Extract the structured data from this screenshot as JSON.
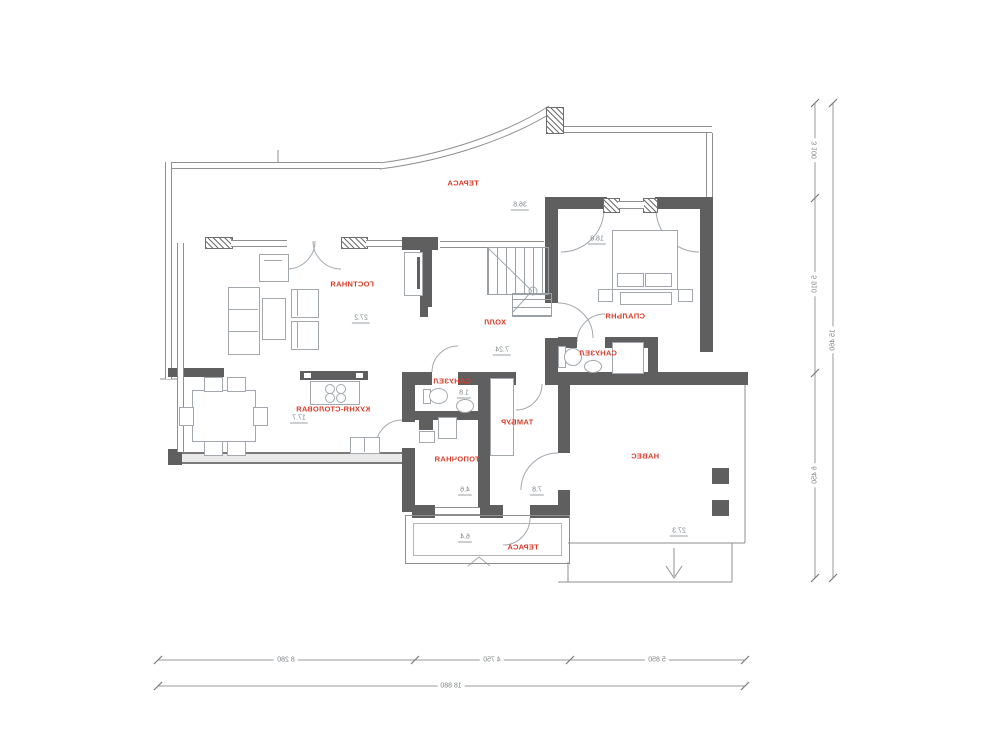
{
  "title": "floor-plan",
  "colors": {
    "label_red": "#da3b29",
    "wall_gray": "#5f5f5f",
    "line_gray": "#8f8f8f",
    "furniture_gray": "#a2a8ae"
  },
  "rooms": [
    {
      "id": "terrace-top",
      "name": "ТЕРАСА",
      "area": "36.8"
    },
    {
      "id": "bedroom",
      "name": "СПАЛЬНЯ",
      "area": "18.8"
    },
    {
      "id": "living",
      "name": "ГОСТИНАЯ",
      "area": "27.2"
    },
    {
      "id": "hall",
      "name": "ХОЛЛ",
      "area": "7.24"
    },
    {
      "id": "bath-master",
      "name": "САНУЗЕЛ"
    },
    {
      "id": "kitchen-dining",
      "name": "КУХНЯ-СТОЛОВАЯ",
      "area": "17.7"
    },
    {
      "id": "bath-small",
      "name": "САНУЗЕЛ",
      "area": "1.8"
    },
    {
      "id": "tambour",
      "name": "ТАМБУР",
      "area": "7.8"
    },
    {
      "id": "boiler-room",
      "name": "ТОПОЧНАЯ",
      "area": "4.6"
    },
    {
      "id": "carport",
      "name": "НАВЕС",
      "area": "27.3"
    },
    {
      "id": "terrace-bottom",
      "name": "ТЕРАСА",
      "area": "6.4"
    }
  ],
  "dimensions": {
    "bottom": {
      "segments": [
        "8 280",
        "4 750",
        "5 850"
      ],
      "total": "18 880"
    },
    "right": {
      "segments": [
        "3 100",
        "5 910",
        "6 450"
      ],
      "total": "15 460"
    }
  },
  "note_mirrored": "all plan text is rendered horizontally mirrored as in source"
}
